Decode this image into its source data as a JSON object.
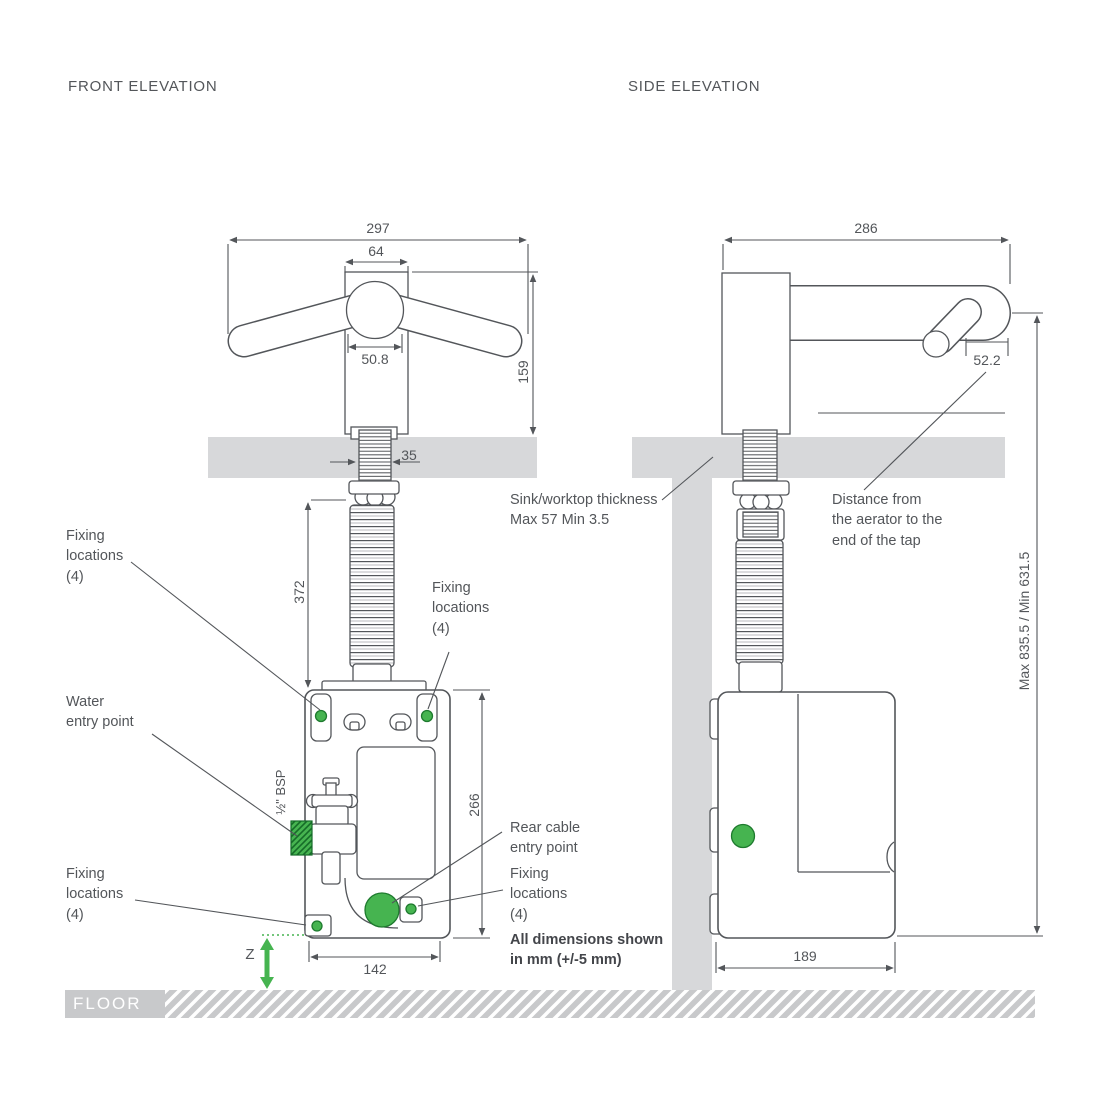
{
  "colors": {
    "line": "#53565A",
    "surface": "#D7D8DA",
    "floor": "#C8C9CB",
    "green": "#46B450",
    "green_dark": "#1E7A2E"
  },
  "front": {
    "title": "FRONT ELEVATION",
    "dims": {
      "overall_width": "297",
      "body_width": "64",
      "head_width": "50.8",
      "tap_height": "159",
      "stem_width": "35",
      "hose_length": "372",
      "box_height": "266",
      "box_width": "142",
      "z": "Z"
    },
    "labels": {
      "fixing_top_left": "Fixing\nlocations\n(4)",
      "fixing_top_right": "Fixing\nlocations\n(4)",
      "water_entry": "Water\nentry point",
      "bsp": "½\" BSP",
      "rear_cable": "Rear cable\nentry point",
      "fixing_bottom_right": "Fixing\nlocations\n(4)",
      "fixing_bottom_left": "Fixing\nlocations\n(4)",
      "note": "All dimensions shown\nin mm (+/-5 mm)",
      "floor": "FLOOR"
    }
  },
  "side": {
    "title": "SIDE ELEVATION",
    "dims": {
      "overall_depth": "286",
      "aerator_to_end": "52.2",
      "height_range": "Max 835.5 / Min 631.5",
      "box_depth": "189"
    },
    "labels": {
      "sink_thickness": "Sink/worktop thickness\nMax 57 Min 3.5",
      "aerator_distance": "Distance from\nthe aerator to the\nend of the tap"
    }
  }
}
